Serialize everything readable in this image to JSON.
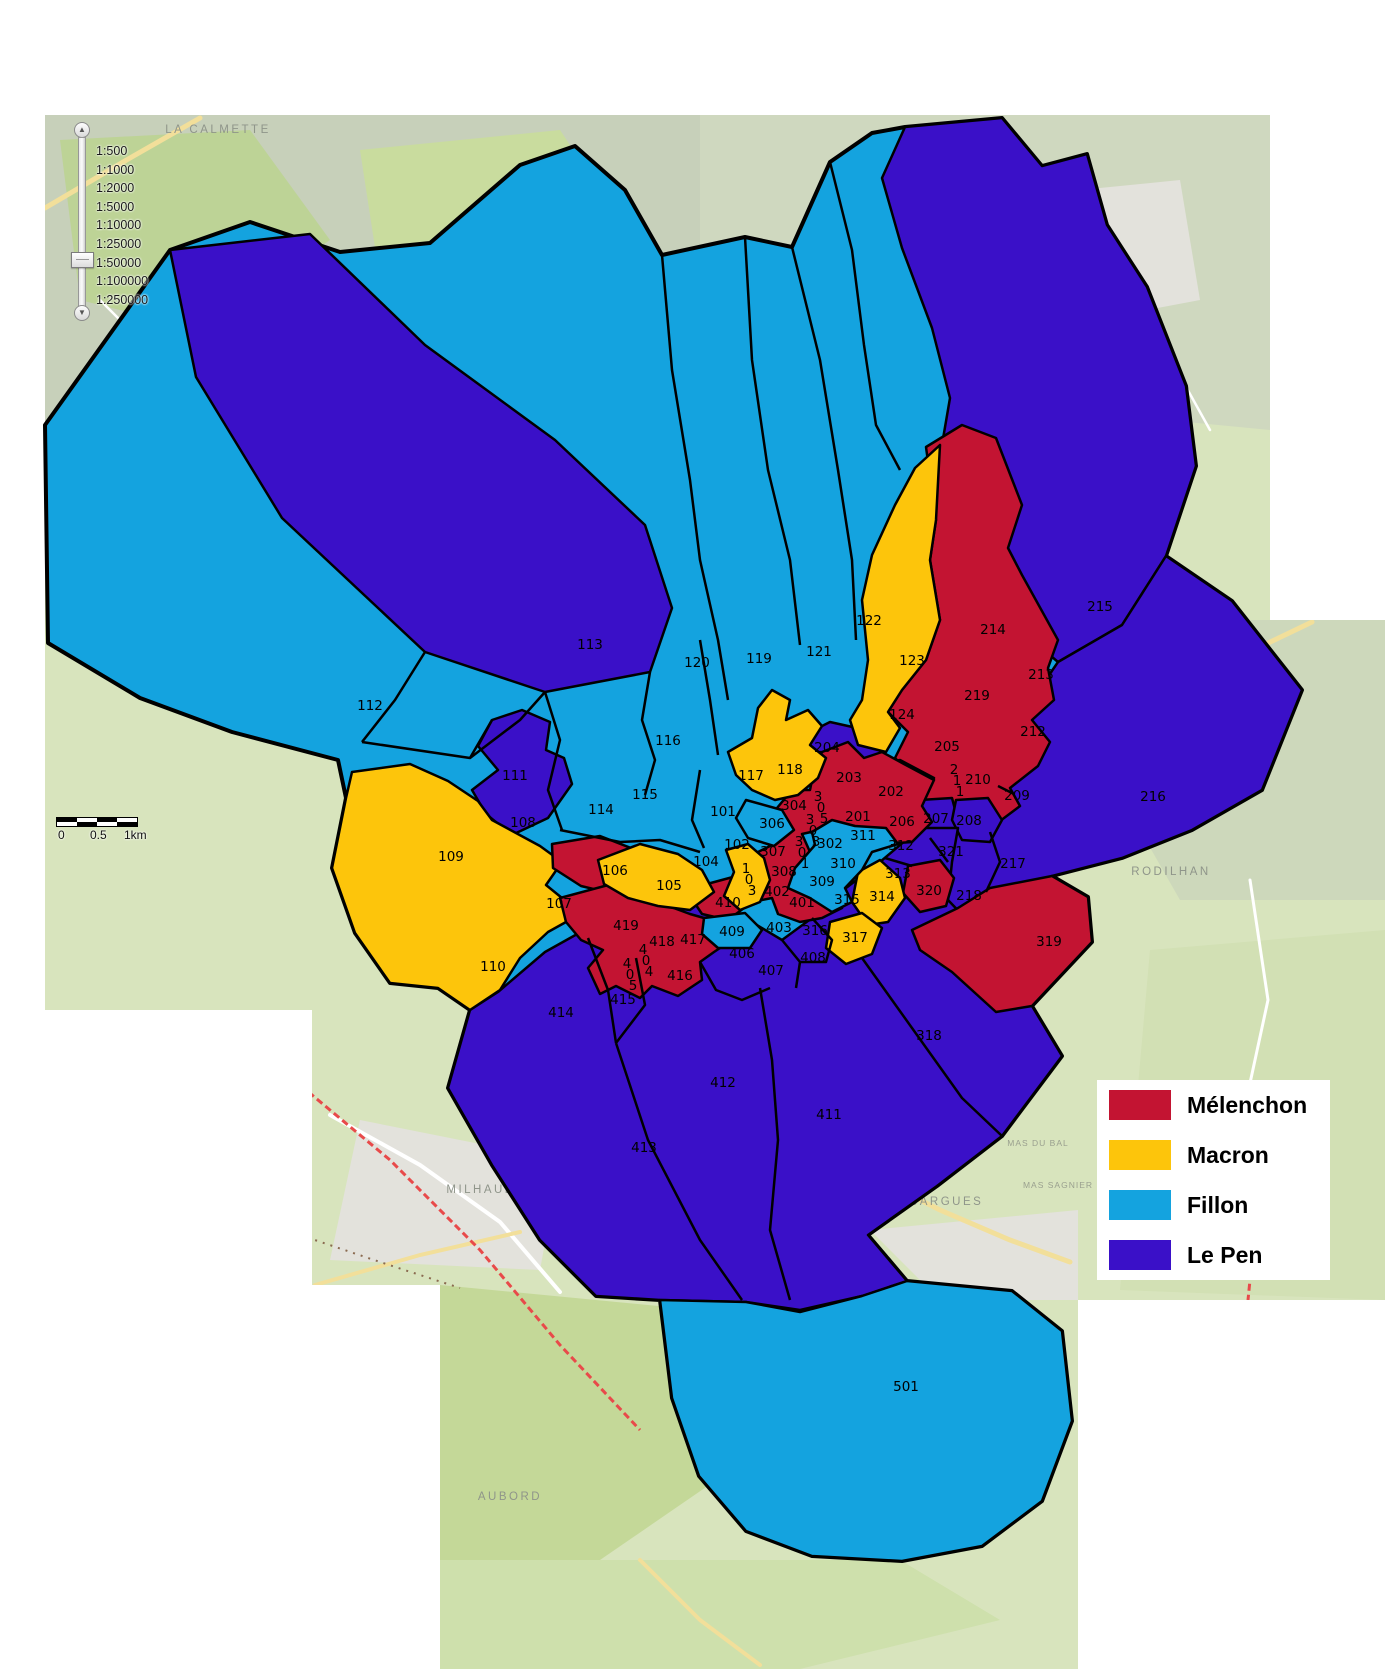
{
  "legend": {
    "entries": [
      {
        "label": "Mélenchon",
        "party": "melenchon",
        "color": "#C31432"
      },
      {
        "label": "Macron",
        "party": "macron",
        "color": "#FDC50B"
      },
      {
        "label": "Fillon",
        "party": "fillon",
        "color": "#14A3DF"
      },
      {
        "label": "Le Pen",
        "party": "lepen",
        "color": "#3A10C8"
      }
    ]
  },
  "zoom_control": {
    "scales": [
      "1:500",
      "1:1000",
      "1:2000",
      "1:5000",
      "1:10000",
      "1:25000",
      "1:50000",
      "1:100000",
      "1:250000"
    ],
    "selected": "1:50000"
  },
  "scale_bar": {
    "ticks": [
      "0",
      "0.5",
      "1km"
    ]
  },
  "basemap": {
    "towns": [
      {
        "name": "LA CALMETTE",
        "x": 218,
        "y": 133,
        "minor": false
      },
      {
        "name": "POULX",
        "x": 1073,
        "y": 248,
        "minor": false
      },
      {
        "name": "RODILHAN",
        "x": 1171,
        "y": 875,
        "minor": false
      },
      {
        "name": "CAISSARGUES",
        "x": 928,
        "y": 1205,
        "minor": false
      },
      {
        "name": "MILHAUD",
        "x": 481,
        "y": 1193,
        "minor": false
      },
      {
        "name": "AUBORD",
        "x": 510,
        "y": 1500,
        "minor": false
      },
      {
        "name": "LA PONCHE",
        "x": 1185,
        "y": 655,
        "minor": true
      },
      {
        "name": "MAS DU BAL",
        "x": 1038,
        "y": 1146,
        "minor": true
      },
      {
        "name": "MAS SAGNIER",
        "x": 1058,
        "y": 1188,
        "minor": true
      }
    ]
  },
  "districts": [
    {
      "id": "101",
      "x": 723,
      "y": 812,
      "party": "fillon"
    },
    {
      "id": "102",
      "x": 737,
      "y": 845,
      "party": "fillon"
    },
    {
      "id": "103",
      "x": 749,
      "y": 869,
      "party": "macron",
      "stack": true
    },
    {
      "id": "104",
      "x": 706,
      "y": 862,
      "party": "fillon"
    },
    {
      "id": "105",
      "x": 669,
      "y": 886,
      "party": "macron"
    },
    {
      "id": "106",
      "x": 615,
      "y": 871,
      "party": "melenchon"
    },
    {
      "id": "107",
      "x": 559,
      "y": 904,
      "party": "fillon"
    },
    {
      "id": "108",
      "x": 523,
      "y": 823,
      "party": "fillon"
    },
    {
      "id": "109",
      "x": 451,
      "y": 857,
      "party": "macron"
    },
    {
      "id": "110",
      "x": 493,
      "y": 967,
      "party": "macron"
    },
    {
      "id": "111",
      "x": 515,
      "y": 776,
      "party": "lepen"
    },
    {
      "id": "112",
      "x": 370,
      "y": 706,
      "party": "fillon"
    },
    {
      "id": "113",
      "x": 590,
      "y": 645,
      "party": "lepen"
    },
    {
      "id": "114",
      "x": 601,
      "y": 810,
      "party": "fillon"
    },
    {
      "id": "115",
      "x": 645,
      "y": 795,
      "party": "fillon"
    },
    {
      "id": "116",
      "x": 668,
      "y": 741,
      "party": "fillon"
    },
    {
      "id": "117",
      "x": 751,
      "y": 776,
      "party": "fillon"
    },
    {
      "id": "118",
      "x": 790,
      "y": 770,
      "party": "macron"
    },
    {
      "id": "119",
      "x": 759,
      "y": 659,
      "party": "fillon"
    },
    {
      "id": "120",
      "x": 697,
      "y": 663,
      "party": "fillon"
    },
    {
      "id": "121",
      "x": 819,
      "y": 652,
      "party": "fillon"
    },
    {
      "id": "122",
      "x": 869,
      "y": 621,
      "party": "fillon"
    },
    {
      "id": "123",
      "x": 912,
      "y": 661,
      "party": "macron"
    },
    {
      "id": "124",
      "x": 902,
      "y": 715,
      "party": "macron"
    },
    {
      "id": "201",
      "x": 858,
      "y": 817,
      "party": "melenchon"
    },
    {
      "id": "202",
      "x": 891,
      "y": 792,
      "party": "lepen"
    },
    {
      "id": "203",
      "x": 849,
      "y": 778,
      "party": "melenchon"
    },
    {
      "id": "204",
      "x": 827,
      "y": 748,
      "party": "lepen"
    },
    {
      "id": "205",
      "x": 947,
      "y": 747,
      "party": "melenchon"
    },
    {
      "id": "206",
      "x": 902,
      "y": 822,
      "party": "melenchon"
    },
    {
      "id": "207",
      "x": 936,
      "y": 819,
      "party": "lepen"
    },
    {
      "id": "208",
      "x": 969,
      "y": 821,
      "party": "lepen"
    },
    {
      "id": "209",
      "x": 1017,
      "y": 796,
      "party": "melenchon"
    },
    {
      "id": "210",
      "x": 978,
      "y": 780,
      "party": "melenchon"
    },
    {
      "id": "211",
      "x": 957,
      "y": 770,
      "party": "melenchon",
      "stack": true
    },
    {
      "id": "212",
      "x": 1033,
      "y": 732,
      "party": "melenchon"
    },
    {
      "id": "213",
      "x": 1041,
      "y": 675,
      "party": "melenchon"
    },
    {
      "id": "214",
      "x": 993,
      "y": 630,
      "party": "melenchon"
    },
    {
      "id": "215",
      "x": 1100,
      "y": 607,
      "party": "lepen"
    },
    {
      "id": "216",
      "x": 1153,
      "y": 797,
      "party": "lepen"
    },
    {
      "id": "217",
      "x": 1013,
      "y": 864,
      "party": "lepen"
    },
    {
      "id": "218",
      "x": 969,
      "y": 896,
      "party": "lepen"
    },
    {
      "id": "219",
      "x": 977,
      "y": 696,
      "party": "melenchon"
    },
    {
      "id": "301",
      "x": 802,
      "y": 842,
      "party": "melenchon",
      "stack": true
    },
    {
      "id": "302",
      "x": 830,
      "y": 844,
      "party": "fillon"
    },
    {
      "id": "303",
      "x": 813,
      "y": 820,
      "party": "melenchon",
      "stack": true
    },
    {
      "id": "304",
      "x": 794,
      "y": 806,
      "party": "melenchon"
    },
    {
      "id": "305",
      "x": 821,
      "y": 797,
      "party": "melenchon",
      "stack": true
    },
    {
      "id": "306",
      "x": 772,
      "y": 824,
      "party": "fillon"
    },
    {
      "id": "307",
      "x": 773,
      "y": 852,
      "party": "melenchon"
    },
    {
      "id": "308",
      "x": 784,
      "y": 872,
      "party": "melenchon"
    },
    {
      "id": "309",
      "x": 822,
      "y": 882,
      "party": "fillon"
    },
    {
      "id": "310",
      "x": 843,
      "y": 864,
      "party": "fillon"
    },
    {
      "id": "311",
      "x": 863,
      "y": 836,
      "party": "fillon"
    },
    {
      "id": "312",
      "x": 901,
      "y": 846,
      "party": "lepen"
    },
    {
      "id": "313",
      "x": 898,
      "y": 874,
      "party": "lepen"
    },
    {
      "id": "314",
      "x": 882,
      "y": 897,
      "party": "macron"
    },
    {
      "id": "315",
      "x": 847,
      "y": 900,
      "party": "lepen"
    },
    {
      "id": "316",
      "x": 815,
      "y": 931,
      "party": "lepen"
    },
    {
      "id": "317",
      "x": 855,
      "y": 938,
      "party": "macron"
    },
    {
      "id": "318",
      "x": 929,
      "y": 1036,
      "party": "lepen"
    },
    {
      "id": "319",
      "x": 1049,
      "y": 942,
      "party": "melenchon"
    },
    {
      "id": "320",
      "x": 929,
      "y": 891,
      "party": "melenchon"
    },
    {
      "id": "321",
      "x": 951,
      "y": 852,
      "party": "lepen"
    },
    {
      "id": "401",
      "x": 802,
      "y": 903,
      "party": "melenchon"
    },
    {
      "id": "402",
      "x": 777,
      "y": 892,
      "party": "melenchon"
    },
    {
      "id": "403",
      "x": 779,
      "y": 928,
      "party": "lepen"
    },
    {
      "id": "404",
      "x": 646,
      "y": 950,
      "party": "melenchon",
      "stack": true
    },
    {
      "id": "405",
      "x": 630,
      "y": 964,
      "party": "melenchon",
      "stack": true
    },
    {
      "id": "406",
      "x": 742,
      "y": 954,
      "party": "lepen"
    },
    {
      "id": "407",
      "x": 771,
      "y": 971,
      "party": "lepen"
    },
    {
      "id": "408",
      "x": 813,
      "y": 958,
      "party": "lepen"
    },
    {
      "id": "409",
      "x": 732,
      "y": 932,
      "party": "fillon"
    },
    {
      "id": "410",
      "x": 728,
      "y": 903,
      "party": "melenchon"
    },
    {
      "id": "411",
      "x": 829,
      "y": 1115,
      "party": "lepen"
    },
    {
      "id": "412",
      "x": 723,
      "y": 1083,
      "party": "lepen"
    },
    {
      "id": "413",
      "x": 644,
      "y": 1148,
      "party": "lepen"
    },
    {
      "id": "414",
      "x": 561,
      "y": 1013,
      "party": "lepen"
    },
    {
      "id": "415",
      "x": 623,
      "y": 1000,
      "party": "lepen"
    },
    {
      "id": "416",
      "x": 680,
      "y": 976,
      "party": "melenchon"
    },
    {
      "id": "417",
      "x": 693,
      "y": 940,
      "party": "melenchon"
    },
    {
      "id": "418",
      "x": 662,
      "y": 942,
      "party": "melenchon"
    },
    {
      "id": "419",
      "x": 626,
      "y": 926,
      "party": "melenchon"
    },
    {
      "id": "501",
      "x": 906,
      "y": 1387,
      "party": "fillon"
    }
  ]
}
